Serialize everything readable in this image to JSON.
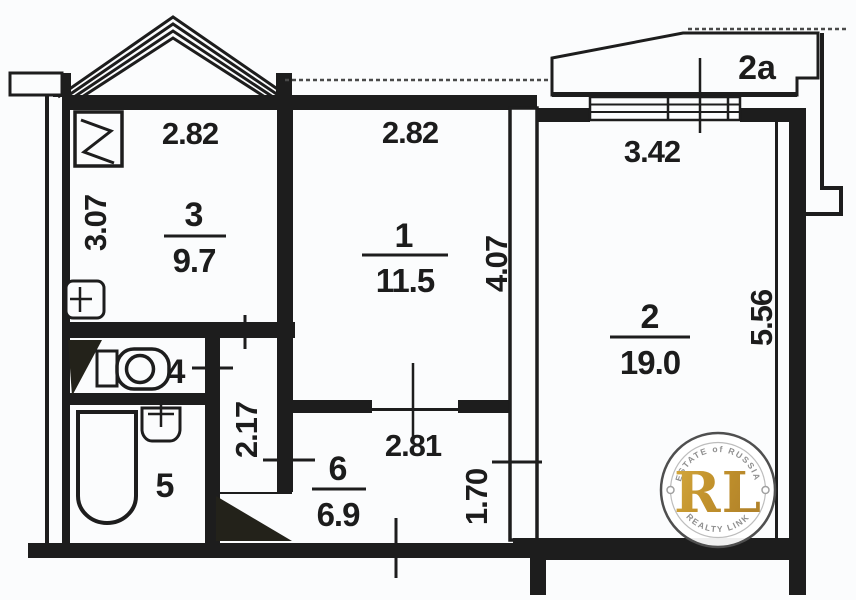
{
  "plan": {
    "kitchen": {
      "number": "3",
      "area": "9.7",
      "width_dim": "2.82",
      "height_dim": "3.07"
    },
    "room1": {
      "number": "1",
      "area": "11.5",
      "width_dim": "2.82",
      "height_dim": "4.07"
    },
    "room2": {
      "number": "2",
      "area": "19.0",
      "width_dim": "3.42",
      "height_dim": "5.56"
    },
    "toilet": {
      "number": "4"
    },
    "bathroom": {
      "number": "5"
    },
    "hall": {
      "number": "6",
      "area": "6.9",
      "width_dim": "2.81",
      "height_dim": "1.70"
    },
    "corridor": {
      "width_dim": "2.17"
    },
    "balcony": {
      "number": "2a"
    }
  },
  "watermark": {
    "top_text": "ESTATE of RUSSIA",
    "monogram": "RL",
    "bottom_text": "REALTY LINK",
    "gold_color": "#c79a32"
  },
  "colors": {
    "ink": "#1d1d1d",
    "paper": "#fbfcfd"
  }
}
